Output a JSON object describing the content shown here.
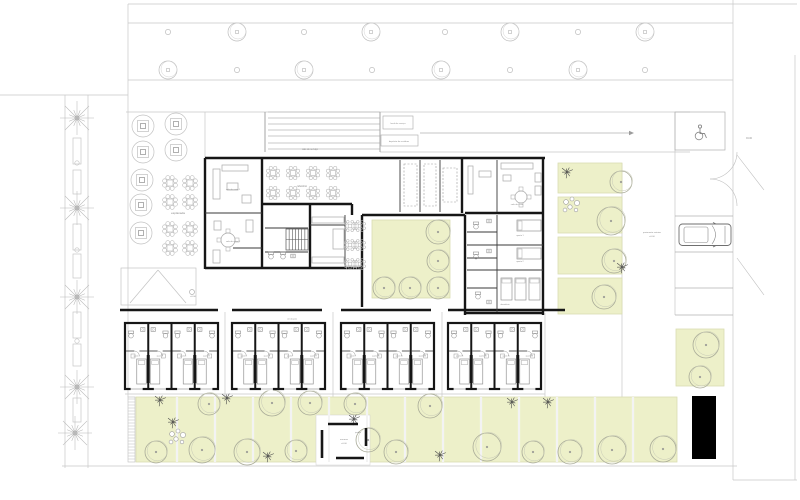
{
  "title": "floor-plan",
  "colors": {
    "wall": "#161616",
    "wall_thin": "#3a3a3a",
    "line_light": "#c7c7c7",
    "line_mid": "#a8a8a8",
    "furniture": "#a9a9a9",
    "tree_outline": "#a9ab98",
    "tree_gray": "#bdbdbd",
    "green_fill": "#edf0c9",
    "green_edge": "#d9ddb2",
    "star_plant": "#4a4a4a",
    "text": "#8a8a8a",
    "black_block": "#000000"
  },
  "labels": {
    "terrace": "esplanada",
    "restaurant": "refeitório",
    "lounge_1": "sala de estar 1",
    "lounge_2": "sala de estar 2",
    "tv_room": "sala de estar",
    "bedroom_1": "quarto 1",
    "bedroom_2": "quarto 2",
    "dorm": "dormitório",
    "corridor": "circulação",
    "room": "quarto",
    "service_ramp": "cais de serviço",
    "service_box_1": "local de serviço",
    "service_box_2": "depósito de resíduos",
    "parking_note_1": "pavimento exterior",
    "parking_note_2": "±0.00",
    "level_right": "±0.00",
    "level_entry": "±0.00",
    "pavilion_1": "arrumos",
    "pavilion_2": "±0.00",
    "garden": "jardim"
  },
  "site": {
    "lines": [
      [
        128,
        4,
        797,
        4
      ],
      [
        128,
        23,
        733,
        23
      ],
      [
        128,
        80,
        733,
        80
      ],
      [
        126,
        112,
        690,
        112
      ],
      [
        380,
        152,
        690,
        152
      ],
      [
        0,
        95,
        128,
        95
      ],
      [
        65,
        95,
        65,
        468
      ],
      [
        88,
        95,
        88,
        468
      ],
      [
        128,
        4,
        128,
        397
      ],
      [
        733,
        0,
        733,
        480
      ],
      [
        795,
        55,
        795,
        480
      ],
      [
        62,
        466,
        737,
        466
      ],
      [
        733,
        480,
        797,
        480
      ],
      [
        225,
        312,
        225,
        397
      ],
      [
        333,
        312,
        333,
        397
      ],
      [
        442,
        312,
        442,
        397
      ],
      [
        545,
        313,
        545,
        462
      ],
      [
        622,
        163,
        622,
        397
      ],
      [
        675,
        112,
        675,
        315
      ],
      [
        125,
        394,
        545,
        394
      ],
      [
        205,
        112,
        205,
        158
      ]
    ],
    "street_trees_big": [
      [
        237,
        32
      ],
      [
        371,
        32
      ],
      [
        510,
        32
      ],
      [
        645,
        32
      ],
      [
        168,
        70
      ],
      [
        304,
        70
      ],
      [
        441,
        70
      ],
      [
        578,
        70
      ]
    ],
    "street_trees_small": [
      [
        168,
        32
      ],
      [
        304,
        32
      ],
      [
        445,
        32
      ],
      [
        578,
        32
      ],
      [
        237,
        70
      ],
      [
        372,
        70
      ],
      [
        510,
        70
      ],
      [
        645,
        70
      ]
    ],
    "palms": [
      [
        77,
        118
      ],
      [
        77,
        208
      ],
      [
        77,
        297
      ],
      [
        77,
        387
      ],
      [
        75,
        433
      ]
    ],
    "street_planters": [
      [
        73,
        138,
        8,
        26
      ],
      [
        73,
        170,
        8,
        24
      ],
      [
        73,
        224,
        8,
        26
      ],
      [
        73,
        254,
        8,
        24
      ],
      [
        73,
        312,
        8,
        26
      ],
      [
        73,
        344,
        8,
        22
      ],
      [
        73,
        398,
        8,
        24
      ]
    ],
    "street_dots": [
      [
        77,
        163
      ],
      [
        77,
        250
      ],
      [
        77,
        341
      ]
    ]
  },
  "service_yard": {
    "ramp_lines_y": [
      112,
      118,
      124,
      130,
      136,
      143,
      149
    ],
    "ramp_x": [
      268,
      380
    ],
    "ramp_sides": [
      [
        265,
        112,
        265,
        152
      ],
      [
        380,
        112,
        380,
        152
      ]
    ],
    "boxes": [
      [
        383,
        116,
        30,
        13
      ],
      [
        381,
        135,
        37,
        11
      ]
    ],
    "arrow": [
      420,
      133,
      629,
      133
    ]
  },
  "terrace": {
    "planters": [
      [
        143,
        126
      ],
      [
        176,
        124
      ],
      [
        143,
        152
      ],
      [
        176,
        150
      ],
      [
        142,
        180
      ],
      [
        141,
        205
      ],
      [
        141,
        233
      ]
    ],
    "clusters": [
      [
        170,
        183
      ],
      [
        190,
        183
      ],
      [
        170,
        202
      ],
      [
        190,
        202
      ],
      [
        170,
        229
      ],
      [
        190,
        229
      ],
      [
        170,
        248
      ],
      [
        190,
        248
      ]
    ]
  },
  "entry": {
    "canopy": [
      121,
      268,
      75,
      37
    ],
    "diagonals": [
      [
        158,
        270,
        130,
        303
      ],
      [
        158,
        270,
        186,
        303
      ]
    ],
    "dot": [
      192,
      292
    ]
  },
  "building": {
    "walls_thick": [
      [
        205,
        158,
        545,
        158
      ],
      [
        205,
        158,
        205,
        269
      ],
      [
        205,
        268,
        362,
        268
      ],
      [
        262,
        158,
        262,
        268
      ],
      [
        310,
        204,
        310,
        268
      ],
      [
        262,
        204,
        352,
        204
      ],
      [
        352,
        204,
        352,
        215
      ],
      [
        362,
        215,
        362,
        307
      ],
      [
        362,
        215,
        465,
        215
      ],
      [
        465,
        215,
        465,
        315
      ],
      [
        543,
        158,
        543,
        315
      ],
      [
        465,
        313,
        543,
        313
      ],
      [
        465,
        213,
        543,
        213
      ],
      [
        462,
        158,
        462,
        213
      ],
      [
        120,
        310,
        218,
        310
      ],
      [
        232,
        310,
        322,
        310
      ],
      [
        341,
        310,
        431,
        310
      ],
      [
        448,
        310,
        565,
        310
      ]
    ],
    "walls_thin": [
      [
        400,
        160,
        400,
        212
      ],
      [
        420,
        160,
        420,
        212
      ],
      [
        440,
        160,
        440,
        212
      ],
      [
        497,
        160,
        497,
        212
      ],
      [
        497,
        215,
        497,
        312
      ],
      [
        467,
        245,
        543,
        245
      ],
      [
        467,
        270,
        543,
        270
      ],
      [
        467,
        288,
        497,
        288
      ],
      [
        205,
        213,
        262,
        213
      ],
      [
        265,
        228,
        308,
        228
      ],
      [
        265,
        252,
        308,
        252
      ],
      [
        345,
        215,
        345,
        268
      ],
      [
        233,
        248,
        262,
        248
      ],
      [
        310,
        225,
        345,
        225
      ],
      [
        467,
        232,
        497,
        232
      ],
      [
        467,
        258,
        497,
        258
      ]
    ],
    "dashed_rects": [
      [
        404,
        164,
        13,
        42
      ],
      [
        424,
        164,
        12,
        42
      ],
      [
        443,
        168,
        14,
        34
      ]
    ],
    "furniture_rects": [
      [
        213,
        169,
        7,
        30
      ],
      [
        222,
        165,
        26,
        6
      ],
      [
        227,
        183,
        11,
        7
      ],
      [
        242,
        195,
        9,
        8
      ],
      [
        213,
        250,
        7,
        13
      ],
      [
        246,
        220,
        7,
        12
      ],
      [
        214,
        221,
        7,
        9
      ],
      [
        501,
        163,
        32,
        6
      ],
      [
        535,
        173,
        6,
        9
      ],
      [
        535,
        186,
        6,
        9
      ],
      [
        503,
        175,
        8,
        6
      ],
      [
        468,
        166,
        5,
        28
      ],
      [
        479,
        171,
        12,
        6
      ],
      [
        312,
        217,
        32,
        6
      ],
      [
        312,
        257,
        32,
        6
      ],
      [
        333,
        229,
        11,
        20
      ]
    ],
    "round_tables": [
      [
        228,
        240,
        7
      ],
      [
        521,
        197,
        6
      ]
    ],
    "beds_east": [
      [
        517,
        220,
        24,
        11
      ],
      [
        517,
        248,
        24,
        11
      ],
      [
        501,
        278,
        11,
        22
      ],
      [
        515,
        278,
        11,
        22
      ],
      [
        529,
        278,
        11,
        22
      ]
    ],
    "toilets": [
      [
        476,
        227
      ],
      [
        476,
        257
      ],
      [
        478,
        297
      ],
      [
        271,
        257
      ],
      [
        283,
        257
      ]
    ],
    "sinks": [
      [
        489,
        221
      ],
      [
        489,
        251
      ],
      [
        489,
        302
      ],
      [
        293,
        256
      ]
    ],
    "stairs": {
      "x": 286,
      "y": 229,
      "w": 22,
      "h": 21,
      "n": 7
    },
    "restaurant_clusters": [
      [
        273,
        173
      ],
      [
        293,
        173
      ],
      [
        313,
        173
      ],
      [
        333,
        173
      ],
      [
        273,
        193
      ],
      [
        293,
        193
      ],
      [
        313,
        193
      ],
      [
        333,
        193
      ]
    ],
    "dining_clusters": [
      [
        350,
        226
      ],
      [
        360,
        226
      ],
      [
        350,
        245
      ],
      [
        360,
        245
      ],
      [
        350,
        264
      ],
      [
        360,
        264
      ]
    ]
  },
  "courtyard": {
    "rect": [
      372,
      220,
      78,
      78
    ],
    "trees": [
      [
        438,
        232,
        12
      ],
      [
        438,
        261,
        11
      ],
      [
        384,
        288,
        11
      ],
      [
        410,
        288,
        11
      ],
      [
        438,
        288,
        11
      ]
    ]
  },
  "right_strip": {
    "plots": [
      [
        558,
        163,
        64,
        30
      ],
      [
        558,
        197,
        64,
        36
      ],
      [
        558,
        237,
        64,
        37
      ],
      [
        558,
        278,
        64,
        36
      ]
    ],
    "trees": [
      [
        621,
        182,
        11
      ],
      [
        611,
        221,
        14
      ],
      [
        614,
        261,
        12
      ],
      [
        604,
        297,
        12
      ]
    ],
    "stars": [
      [
        567,
        172
      ],
      [
        622,
        267
      ]
    ],
    "stones": [
      572,
      206
    ]
  },
  "patch_a": {
    "rect": [
      676,
      329,
      48,
      57
    ],
    "trees": [
      [
        706,
        345,
        13
      ],
      [
        700,
        377,
        11
      ]
    ]
  },
  "gardens": {
    "rect": [
      136,
      397,
      541,
      65
    ],
    "pavilion_cut": [
      316,
      415,
      54,
      50
    ],
    "dividers": [
      177,
      215,
      253,
      291,
      329,
      367,
      405,
      443,
      481,
      519,
      557,
      595,
      633
    ],
    "tick_strip": [
      128,
      397,
      7,
      65
    ],
    "trees": [
      [
        209,
        404,
        11
      ],
      [
        272,
        403,
        13
      ],
      [
        310,
        403,
        12
      ],
      [
        355,
        404,
        11
      ],
      [
        430,
        406,
        12
      ],
      [
        487,
        447,
        14
      ],
      [
        156,
        452,
        11
      ],
      [
        202,
        450,
        13
      ],
      [
        247,
        452,
        13
      ],
      [
        296,
        451,
        11
      ],
      [
        396,
        452,
        12
      ],
      [
        533,
        452,
        11
      ],
      [
        570,
        452,
        12
      ],
      [
        612,
        450,
        14
      ],
      [
        663,
        449,
        13
      ],
      [
        368,
        440,
        12
      ]
    ],
    "stars": [
      [
        160,
        400
      ],
      [
        173,
        422
      ],
      [
        227,
        398
      ],
      [
        268,
        456
      ],
      [
        354,
        419
      ],
      [
        512,
        402
      ],
      [
        548,
        402
      ],
      [
        440,
        455
      ]
    ],
    "stones": [
      178,
      438
    ]
  },
  "pavilion_walls": [
    [
      328,
      424,
      358,
      424
    ],
    [
      322,
      430,
      322,
      458
    ],
    [
      336,
      458,
      364,
      458
    ],
    [
      366,
      428,
      366,
      446
    ]
  ],
  "rooms": {
    "blocks": [
      125,
      232,
      341,
      448
    ],
    "block_w": 93,
    "per_block": 4,
    "y": 323,
    "h": 66
  },
  "parking": {
    "wheelchair_box": [
      675,
      112,
      50,
      38
    ],
    "stall_ys": [
      216,
      252,
      288,
      315
    ],
    "stall_x": [
      675,
      733
    ],
    "car": [
      679,
      224,
      52,
      21.5
    ],
    "black_rect": [
      692,
      396,
      24,
      63
    ],
    "gate_diagonals": [
      [
        737,
        155,
        764,
        190
      ],
      [
        737,
        258,
        764,
        295
      ]
    ],
    "gate_arcs": [
      [
        737,
        152,
        710,
        179,
        1
      ],
      [
        737,
        206,
        710,
        179,
        0
      ]
    ]
  }
}
